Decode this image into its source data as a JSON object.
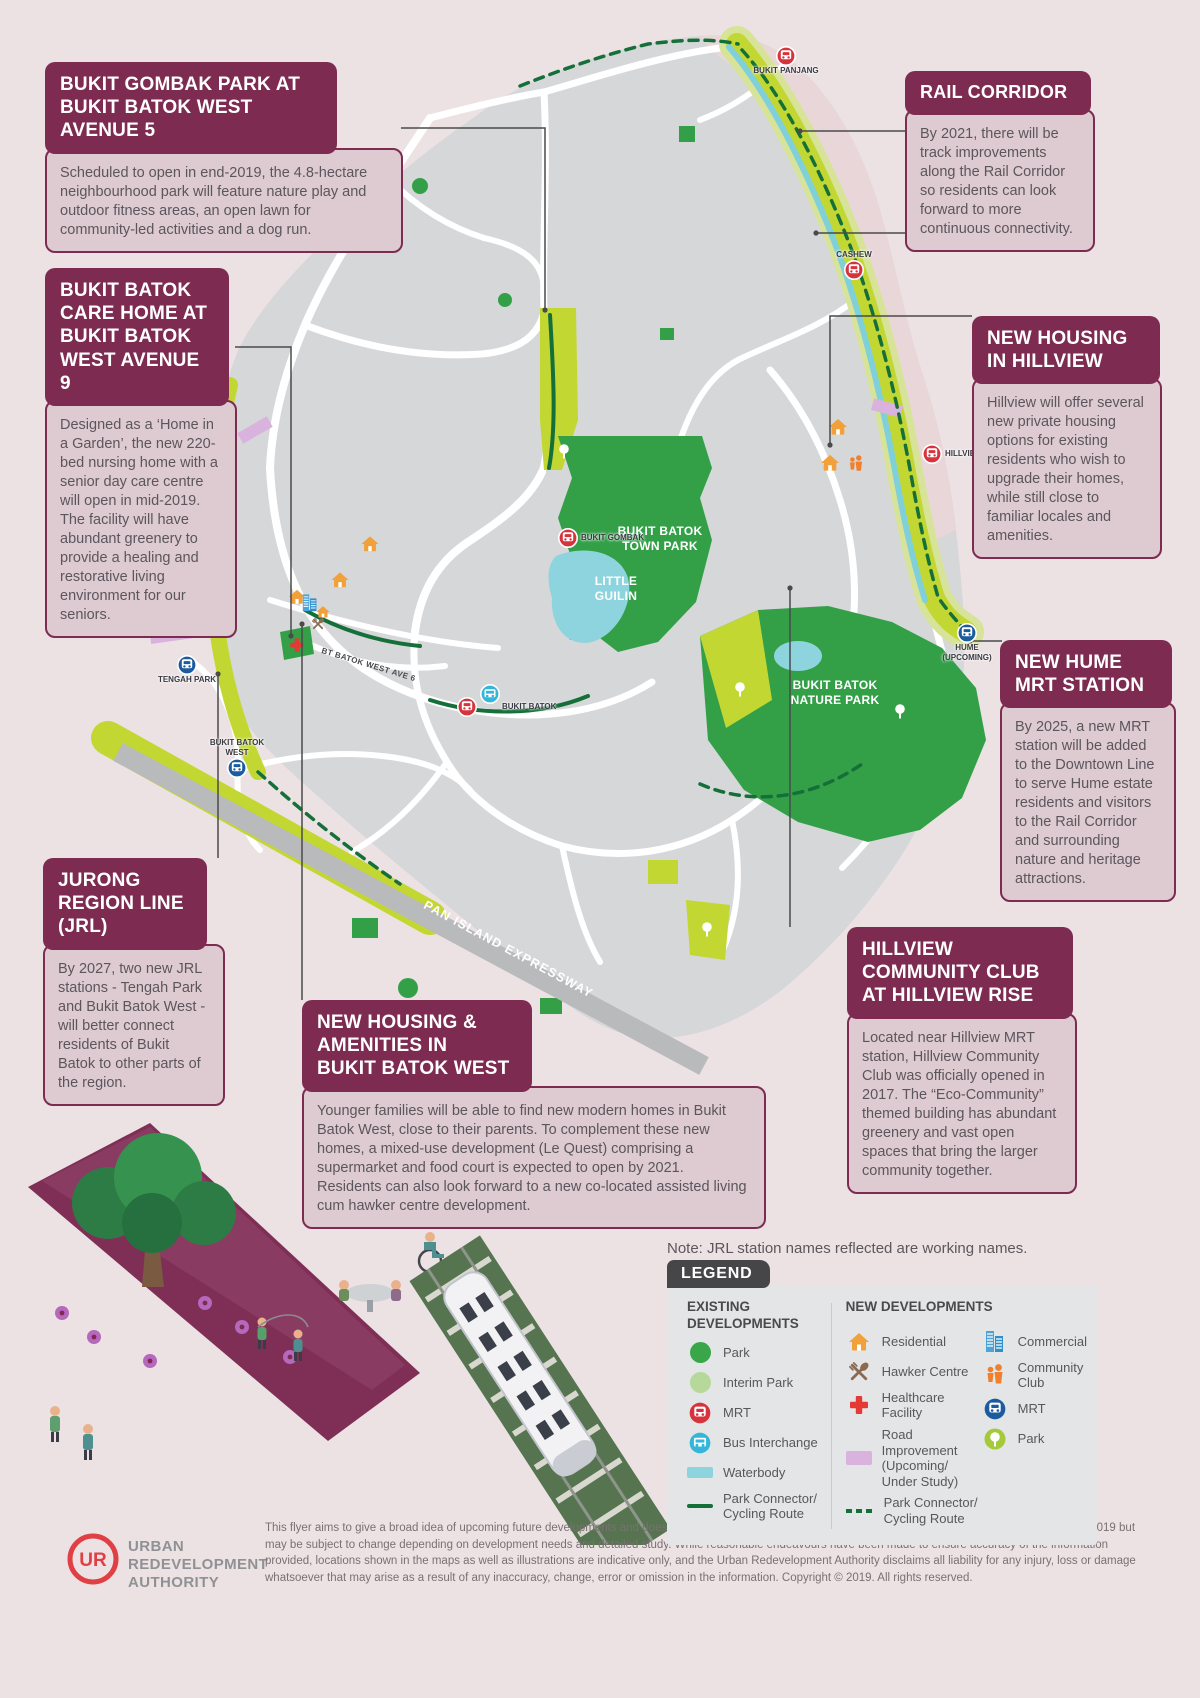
{
  "colors": {
    "background": "#ece2e3",
    "accent_maroon": "#7d2b50",
    "callout_body_bg": "#decbd1",
    "map_gray": "#d6d7d9",
    "park_green": "#33a048",
    "interim_park_green": "#b7d89b",
    "corridor_green": "#c3d733",
    "waterbody_cyan": "#8ed4de",
    "connector_dark_green": "#156f39",
    "mrt_existing_red": "#d7333d",
    "mrt_new_blue": "#1b5b9e",
    "bus_cyan": "#35b6d9",
    "residential_orange": "#f2a13a",
    "commercial_blue": "#4ba3d9",
    "hawker_brown": "#8a6a52",
    "healthcare_red": "#e53935",
    "community_orange": "#f07f2e",
    "road_improvement_purple": "#d9b3de",
    "expressway_gray": "#b9babc",
    "legend_badge_gray": "#464649",
    "ura_red": "#e04043"
  },
  "callouts": [
    {
      "id": "bukit-gombak-park",
      "title": "BUKIT GOMBAK PARK AT\nBUKIT BATOK WEST AVENUE 5",
      "body": "Scheduled to open in end-2019, the 4.8-hectare neighbourhood park will feature nature play and outdoor fitness areas, an open lawn for community-led activities and a dog run."
    },
    {
      "id": "bukit-batok-care-home",
      "title": "BUKIT BATOK\nCARE HOME AT\nBUKIT BATOK\nWEST AVENUE 9",
      "body": "Designed as a ‘Home in a Garden’, the new 220-bed nursing home with a senior day care centre will open in mid-2019. The facility will have abundant greenery to provide a healing and restorative living environment for our seniors."
    },
    {
      "id": "rail-corridor",
      "title": "RAIL CORRIDOR",
      "body": "By 2021, there will be track improvements along the Rail Corridor so residents can look forward to more continuous connectivity."
    },
    {
      "id": "new-housing-hillview",
      "title": "NEW HOUSING\nIN HILLVIEW",
      "body": "Hillview will offer several new private housing options for existing residents who wish to upgrade their homes, while still close to familiar locales and amenities."
    },
    {
      "id": "new-hume-mrt",
      "title": "NEW HUME\nMRT STATION",
      "body": "By 2025, a new MRT station will be added to the Downtown Line to serve Hume estate residents and visitors to the Rail Corridor and surrounding nature and heritage attractions."
    },
    {
      "id": "hillview-community-club",
      "title": "HILLVIEW\nCOMMUNITY CLUB\nAT HILLVIEW RISE",
      "body": "Located near Hillview MRT station, Hillview Community Club was officially opened in 2017. The “Eco-Community” themed building has abundant greenery and vast open spaces that bring the larger community together."
    },
    {
      "id": "jurong-region-line",
      "title": "JURONG\nREGION LINE\n(JRL)",
      "body": "By 2027, two new JRL stations - Tengah Park and Bukit Batok West - will better connect residents of Bukit Batok to other parts of the region."
    },
    {
      "id": "new-housing-bukit-batok-west",
      "title": "NEW HOUSING &\nAMENITIES IN\nBUKIT BATOK WEST",
      "body": "Younger families will be able to find new modern homes in Bukit Batok West, close to their parents. To complement these new homes, a mixed-use development (Le Quest) comprising a supermarket and food court is expected to open by 2021. Residents can also look forward to a new co-located assisted living cum hawker centre development."
    }
  ],
  "map": {
    "labels": {
      "town_park": "BUKIT BATOK\nTOWN PARK",
      "little_guilin": "LITTLE\nGUILIN",
      "nature_park": "BUKIT BATOK\nNATURE PARK",
      "expressway": "PAN ISLAND EXPRESSWAY",
      "ave6": "BT BATOK WEST AVE 6"
    },
    "stations": [
      {
        "label": "BUKIT PANJANG",
        "kind": "mrt-existing"
      },
      {
        "label": "CASHEW",
        "kind": "mrt-existing"
      },
      {
        "label": "HILLVIEW",
        "kind": "mrt-existing"
      },
      {
        "label": "BUKIT GOMBAK",
        "kind": "mrt-existing"
      },
      {
        "label": "BUKIT BATOK",
        "kind": "mrt-existing-with-bus-interchange"
      },
      {
        "label": "HUME\n(UPCOMING)",
        "kind": "mrt-new"
      },
      {
        "label": "TENGAH PARK",
        "kind": "mrt-new-jrl"
      },
      {
        "label": "BUKIT BATOK\nWEST",
        "kind": "mrt-new-jrl"
      }
    ]
  },
  "note": {
    "text": "Note: JRL station names reflected are working names."
  },
  "legend": {
    "badge": "LEGEND",
    "existing": {
      "heading": "EXISTING\nDEVELOPMENTS",
      "items": [
        {
          "label": "Park",
          "icon": "park-circle"
        },
        {
          "label": "Interim Park",
          "icon": "interim-park-circle"
        },
        {
          "label": "MRT",
          "icon": "mrt-red-icon"
        },
        {
          "label": "Bus Interchange",
          "icon": "bus-interchange-icon"
        },
        {
          "label": "Waterbody",
          "icon": "waterbody-swatch"
        },
        {
          "label": "Park Connector/\nCycling Route",
          "icon": "solid-green-line"
        }
      ]
    },
    "new": {
      "heading": "NEW DEVELOPMENTS",
      "col1": [
        {
          "label": "Residential",
          "icon": "house-icon"
        },
        {
          "label": "Hawker Centre",
          "icon": "utensils-icon"
        },
        {
          "label": "Healthcare Facility",
          "icon": "red-cross-icon"
        },
        {
          "label": "Road Improvement\n(Upcoming/\nUnder Study)",
          "icon": "purple-swatch"
        },
        {
          "label": "Park Connector/\nCycling Route",
          "icon": "dashed-green-line"
        }
      ],
      "col2": [
        {
          "label": "Commercial",
          "icon": "buildings-icon"
        },
        {
          "label": "Community Club",
          "icon": "people-icon"
        },
        {
          "label": "MRT",
          "icon": "mrt-blue-icon"
        },
        {
          "label": "Park",
          "icon": "tree-circle-icon"
        }
      ]
    }
  },
  "footer": {
    "logo_monogram": "UR",
    "org_lines": [
      "URBAN",
      "REDEVELOPMENT",
      "AUTHORITY"
    ],
    "disclaimer": "This flyer aims to give a broad idea of upcoming future developments and does not form part of the Draft Master Plan 2019. All information is updated as at March 2019 but may be subject to change depending on development needs and detailed study. While reasonable endeavours have been made to ensure accuracy of the information provided, locations shown in the maps as well as illustrations are indicative only, and the Urban Redevelopment Authority disclaims all liability for any injury, loss or damage whatsoever that may arise as a result of any inaccuracy, change, error or omission in the information. Copyright © 2019. All rights reserved."
  }
}
